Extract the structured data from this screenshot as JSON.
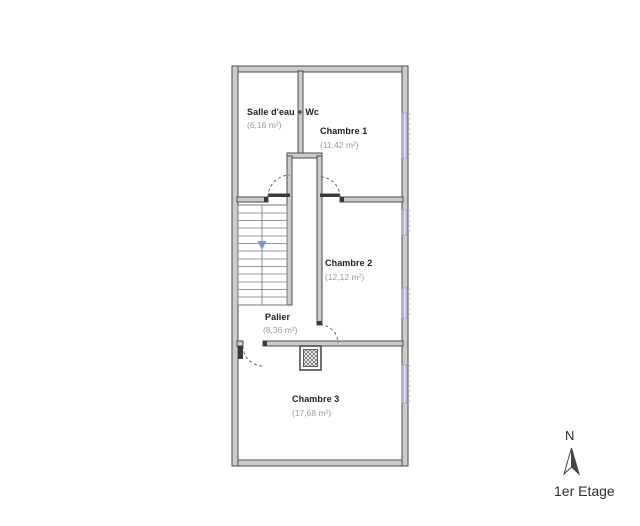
{
  "floor_plan": {
    "title": "1er Etage",
    "compass_label": "N",
    "rooms": [
      {
        "id": "salle-eau-wc",
        "name": "Salle d'eau + Wc",
        "area": "(6,16 m²)"
      },
      {
        "id": "chambre-1",
        "name": "Chambre 1",
        "area": "(11,42 m²)"
      },
      {
        "id": "chambre-2",
        "name": "Chambre 2",
        "area": "(12,12 m²)"
      },
      {
        "id": "palier",
        "name": "Palier",
        "area": "(8,36 m²)"
      },
      {
        "id": "chambre-3",
        "name": "Chambre 3",
        "area": "(17,68 m²)"
      }
    ],
    "colors": {
      "wall_fill": "#cbcbcb",
      "wall_edge": "#4e4e4e",
      "window": "#b9badf",
      "stair_arrow": "#7b96d4",
      "room_name_text": "#1f1f1f",
      "area_text": "#9a9a9a"
    }
  }
}
